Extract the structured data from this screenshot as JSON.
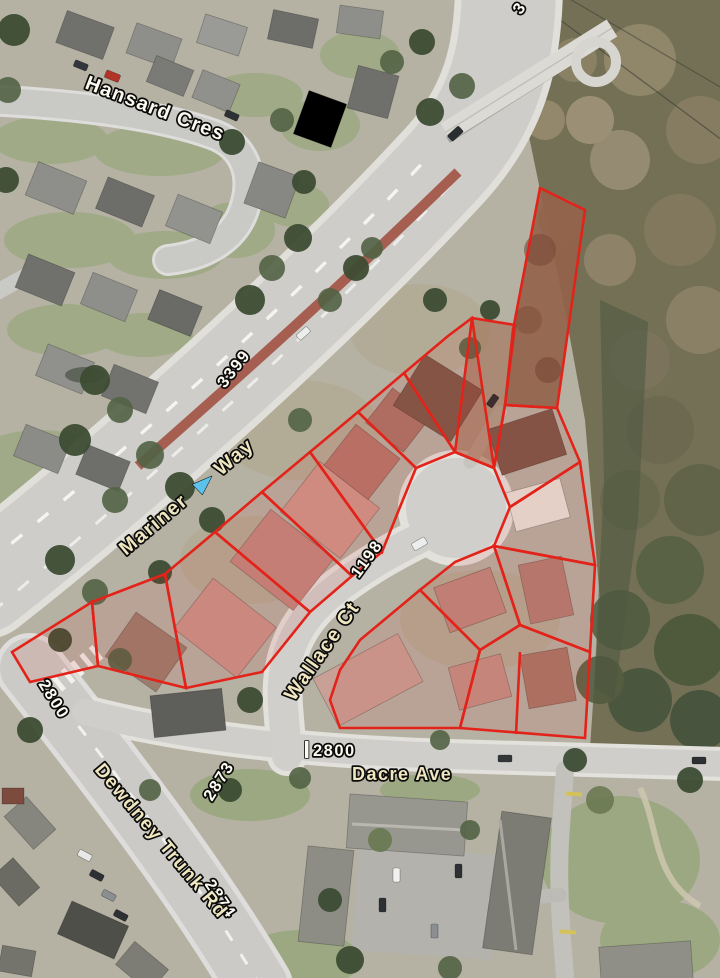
{
  "map": {
    "streets": {
      "hansard": "Hansard  Cres",
      "mariner_word1": "Mariner",
      "mariner_word2": "Way",
      "wallace": "Wallace  Ct",
      "dacre": "Dacre  Ave",
      "dewdney": "Dewdney  Trunk  Rd"
    },
    "blocks": {
      "mariner_upper": "3399",
      "wallace": "1198",
      "mariner_lower": "2800",
      "dacre": "2800",
      "dewdney_north": "2873",
      "dewdney_south": "2874",
      "edge_partial": "3"
    },
    "colors": {
      "parcel_outline": "#e3231a",
      "parcel_fill_tint": "rgba(225,38,25,0.10)",
      "label_white": "#fdfaef",
      "label_cream": "#f0e7c0",
      "direction_arrow_blue": "#5cc2ec",
      "median_red": "#a3574b"
    }
  }
}
